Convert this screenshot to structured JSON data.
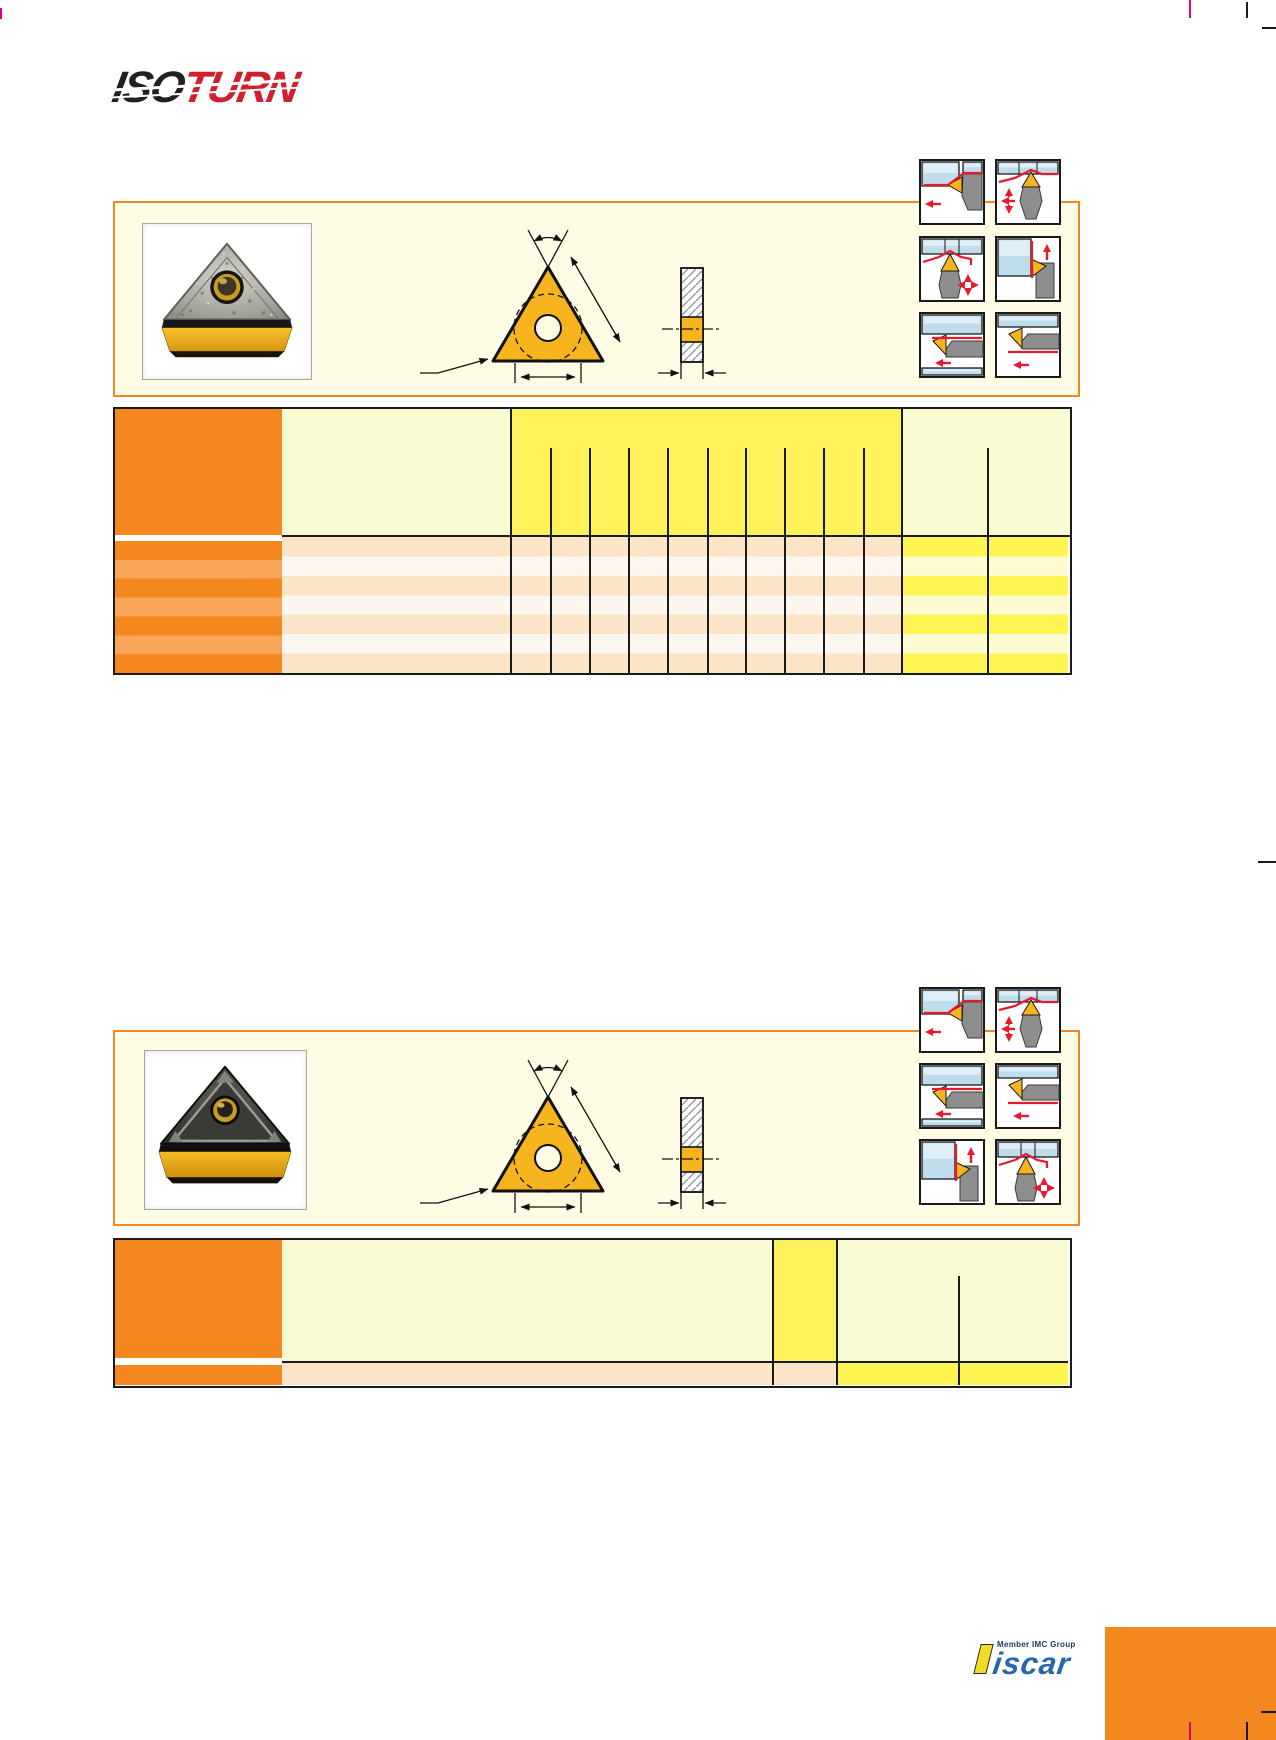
{
  "page": {
    "background": "#ffffff"
  },
  "logo": {
    "iso": "ISO",
    "turn": "TURN",
    "iso_color": "#231f20",
    "turn_color": "#cf2030"
  },
  "brand_footer": {
    "member_label": "Member IMC Group",
    "brand": "iscar",
    "brand_color": "#2767ae",
    "accent_yellow": "#f3dc26"
  },
  "palette": {
    "panel_border": "#f0881f",
    "panel_bg": "#fffce6",
    "header_orange": "#f5871f",
    "orange_light_stripe": "#f9a65a",
    "header_pale_yellow": "#fafad2",
    "header_bright_yellow": "#fef25a",
    "row_peach": "#fce4c9",
    "row_cream": "#fef7f0",
    "row_yellow": "#fef452",
    "row_yellow_pale": "#fefbd2",
    "line_black": "#1a1a1a",
    "insert_gold": "#f6b41f",
    "diagram_red": "#e8192c",
    "icon_steel_blue": "#bfdcec",
    "registration_magenta": "#e6007e",
    "footer_orange": "#f5871f"
  },
  "section1": {
    "insert_photo": "triangular-insert-photo",
    "drawing": "insert-dimension-drawing",
    "icons": [
      "external-turning-left-icon",
      "profile-turning-multi-icon",
      "peak-profile-icon",
      "facing-up-icon",
      "boring-left-icon",
      "back-boring-left-icon"
    ],
    "table": {
      "left_header_column": true,
      "dimension_subcolumns": 10,
      "right_subcolumns": 2,
      "data_rows": 7
    }
  },
  "section2": {
    "insert_photo": "triangular-insert-photo-chipbreaker",
    "drawing": "insert-dimension-drawing",
    "icons": [
      "external-turning-left-icon",
      "profile-turning-multi-icon",
      "boring-left-icon",
      "back-boring-left-icon",
      "facing-up-icon",
      "peak-profile-icon"
    ],
    "table": {
      "left_header_column": true,
      "highlight_columns": 1,
      "data_rows": 1
    }
  }
}
